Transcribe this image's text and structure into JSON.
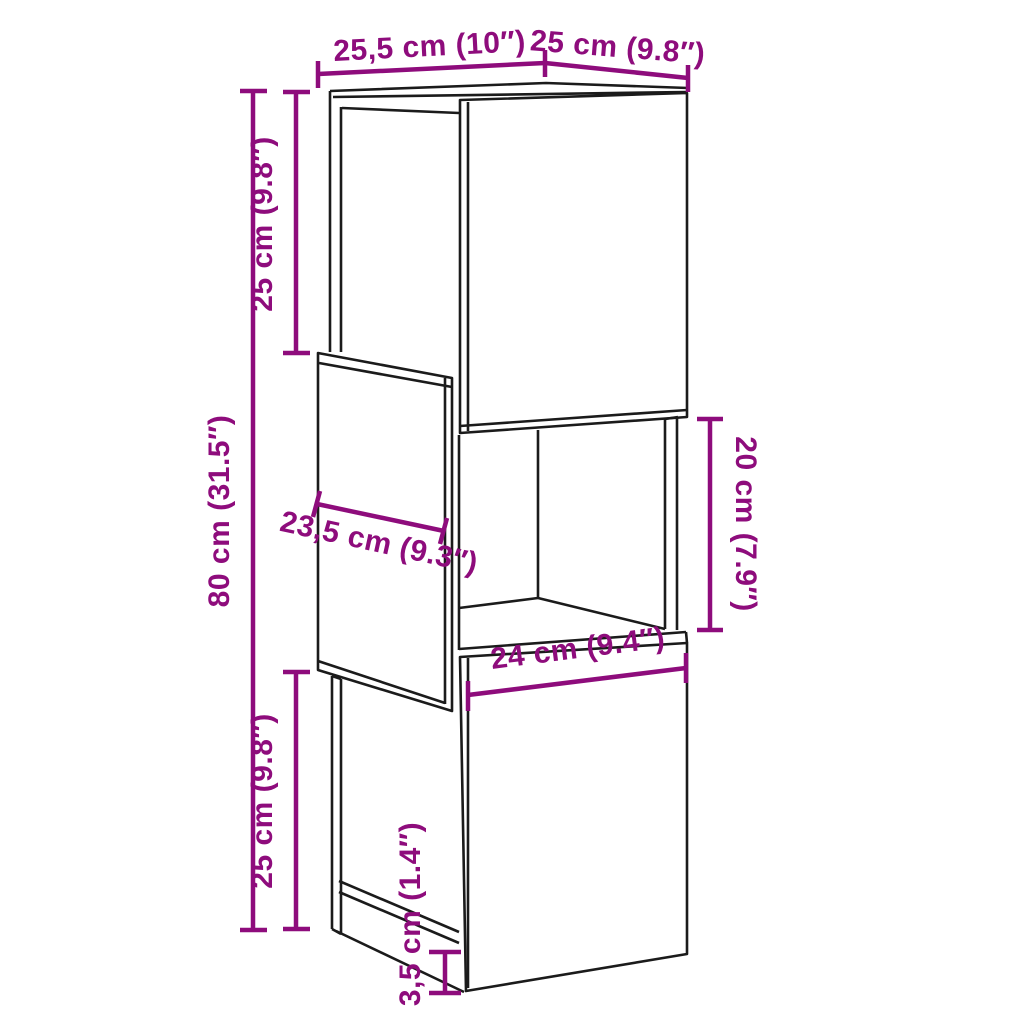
{
  "diagram": {
    "type": "furniture-dimension-diagram",
    "subject": "three-tier corner cabinet line drawing"
  },
  "colors": {
    "dimension": "#8E0C7C",
    "cabinet_line": "#1b1b1b",
    "background": "#ffffff"
  },
  "labels": {
    "depth_top": "25,5 cm (10″)",
    "width_top": "25 cm (9.8″)",
    "height_upper": "25 cm (9.8″)",
    "height_total": "80 cm (31.5″)",
    "height_lower": "25 cm (9.8″)",
    "height_middle_right": "20 cm (7.9″)",
    "depth_middle": "23,5 cm (9.3″)",
    "width_bottom": "24 cm (9.4″)",
    "height_plinth": "3,5 cm (1.4″)"
  }
}
